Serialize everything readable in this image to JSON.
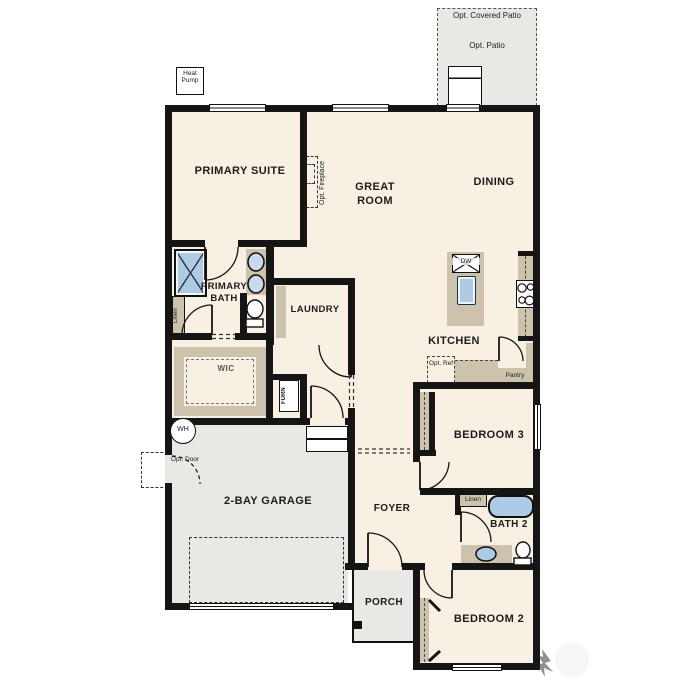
{
  "plan_title": "Single-story floor plan",
  "labels": {
    "opt_covered_patio": "Opt. Covered Patio",
    "opt_patio": "Opt. Patio",
    "heat_pump": "Heat Pump",
    "primary_suite": "PRIMARY SUITE",
    "great_room": "GREAT ROOM",
    "dining": "DINING",
    "opt_fireplace": "Opt. Fireplace",
    "primary_bath": "PRIMARY BATH",
    "linen_primary": "Linen",
    "laundry": "LAUNDRY",
    "wic": "WIC",
    "furn": "FURN",
    "dw": "DW",
    "kitchen": "KITCHEN",
    "opt_ref": "Opt. Ref",
    "pantry": "Pantry",
    "bedroom_3": "BEDROOM 3",
    "wh": "WH",
    "opt_door": "Opt. Door",
    "garage": "2-BAY GARAGE",
    "foyer": "FOYER",
    "linen_bath2": "Linen",
    "bath_2": "BATH 2",
    "porch": "PORCH",
    "bedroom_2": "BEDROOM 2"
  },
  "colors": {
    "floor": "#f7f0e3",
    "exterior_concrete": "#e9e8e4",
    "cabinetry": "#cdc2ac",
    "fixture_blue": "#aecbe6",
    "wall": "#151515"
  }
}
